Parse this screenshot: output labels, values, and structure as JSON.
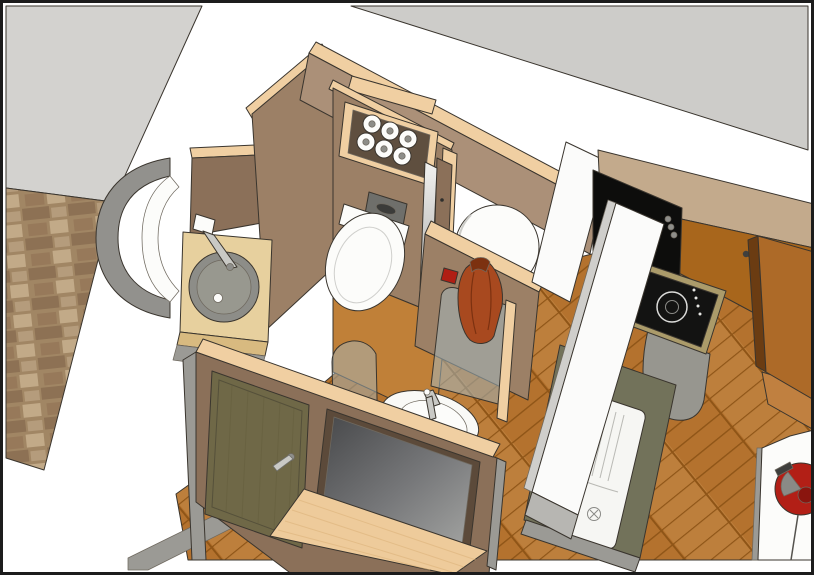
{
  "meta": {
    "type": "3d-interior-render",
    "style": "sketchup-like shaded render with edge lines",
    "viewpoint": "bird's-eye perspective from south-east",
    "subject": "compact bathroom and kitchen module of a tiny home"
  },
  "scene": {
    "objects": [
      "stone accent wall",
      "gray ceiling planes",
      "wood parquet floor",
      "corner vanity with round washbasin and faucet",
      "curved gray shower dome",
      "toilet-paper niche with six rolls",
      "flush plate",
      "wall-hung toilet",
      "pocket mirror door",
      "round shower cabin",
      "curved glass shower screen",
      "glass fin",
      "hand basin with faucet",
      "hanging rust towel",
      "red wall hook",
      "interior door with lever handle",
      "framed mirror panel",
      "drop-leaf pine shelf",
      "black oven tower",
      "induction hob with burner ring",
      "khaki hob counter",
      "kitchen sink with drainboard",
      "lifted white counter lid",
      "towel bar",
      "tall orange cabinet",
      "white corner panel with red reel"
    ]
  },
  "palette": {
    "canvas": "#ffffff",
    "frame": "#1c1c1c",
    "planeGray": "#d3d2cf",
    "planeGray2": "#cdccc9",
    "stoneBase": "#a18664",
    "stoneDark": "#8d7154",
    "stoneMid": "#97795a",
    "stoneLight": "#b59c7c",
    "stoneLighter": "#c2aa88",
    "floorBase": "#b4722e",
    "floorDark": "#8f5517",
    "floorLight": "#c98f4d",
    "floorRoom": "#c08038",
    "plinthGray": "#9b9a95",
    "wallWood": "#9c8066",
    "wallWoodLight": "#ab9078",
    "wallWoodDark": "#8b7059",
    "pine": "#f0cfa2",
    "nicheDark": "#5f4f3f",
    "porcelain": "#fcfcfa",
    "porcelainShade": "#cfcfcb",
    "flushPlate": "#6f6f6b",
    "flushButton": "#3b3b39",
    "basinGray": "#8d8d88",
    "basinInner": "#98988f",
    "counterBirch": "#e7d09e",
    "counterBirchEdge": "#d8ba80",
    "domeGray": "#92918d",
    "glass": "#a4b6bc",
    "glassEdge": "#5d6b70",
    "towel": "#a8491f",
    "towelDark": "#7c3110",
    "hookRed": "#b01e14",
    "trayWhite": "#f9f9f6",
    "chrome": "#c9c9c5",
    "chromeDark": "#8e8e8a",
    "kitchenWall": "#c3aa8c",
    "panelOrange": "#a8661c",
    "cabinetOrange": "#ad6a28",
    "cabinetOrangeLight": "#c08040",
    "cabinetEdgeDark": "#6b3c12",
    "ovenBlack": "#0d0d0c",
    "handleGray": "#4a4a48",
    "hobBlack": "#131312",
    "hobRing": "#dcdcda",
    "hobDots": "#e6e6e3",
    "counterKhaki": "#ab9b6a",
    "grayCap": "#97968f",
    "counterOlive": "#72725a",
    "sinkWhite": "#f6f6f3",
    "sinkLine": "#b9b9b4",
    "knobOlive": "#c2c29c",
    "slabWhite": "#fbfbfa",
    "slabEdge": "#b7b6b2",
    "slabSide": "#cfcecb",
    "doorOlive": "#6f6847",
    "doorGrain": "#5e5838",
    "doorFrameLine": "#55503a",
    "mirrorFrame": "#5c4a3a",
    "mirrorDark": "#48494b",
    "mirrorMid": "#77787a",
    "mirrorLight": "#a2a3a1",
    "flapPine": "#eecb9b",
    "flapGrain": "#d9ae74",
    "panelWhiteBR": "#fcfcfa",
    "redObj": "#b21f16",
    "redObjDark": "#8a150e",
    "objGray": "#3f3f3d",
    "sliverLight": "#f2f2f0",
    "sliverDark": "#9a9a97"
  }
}
